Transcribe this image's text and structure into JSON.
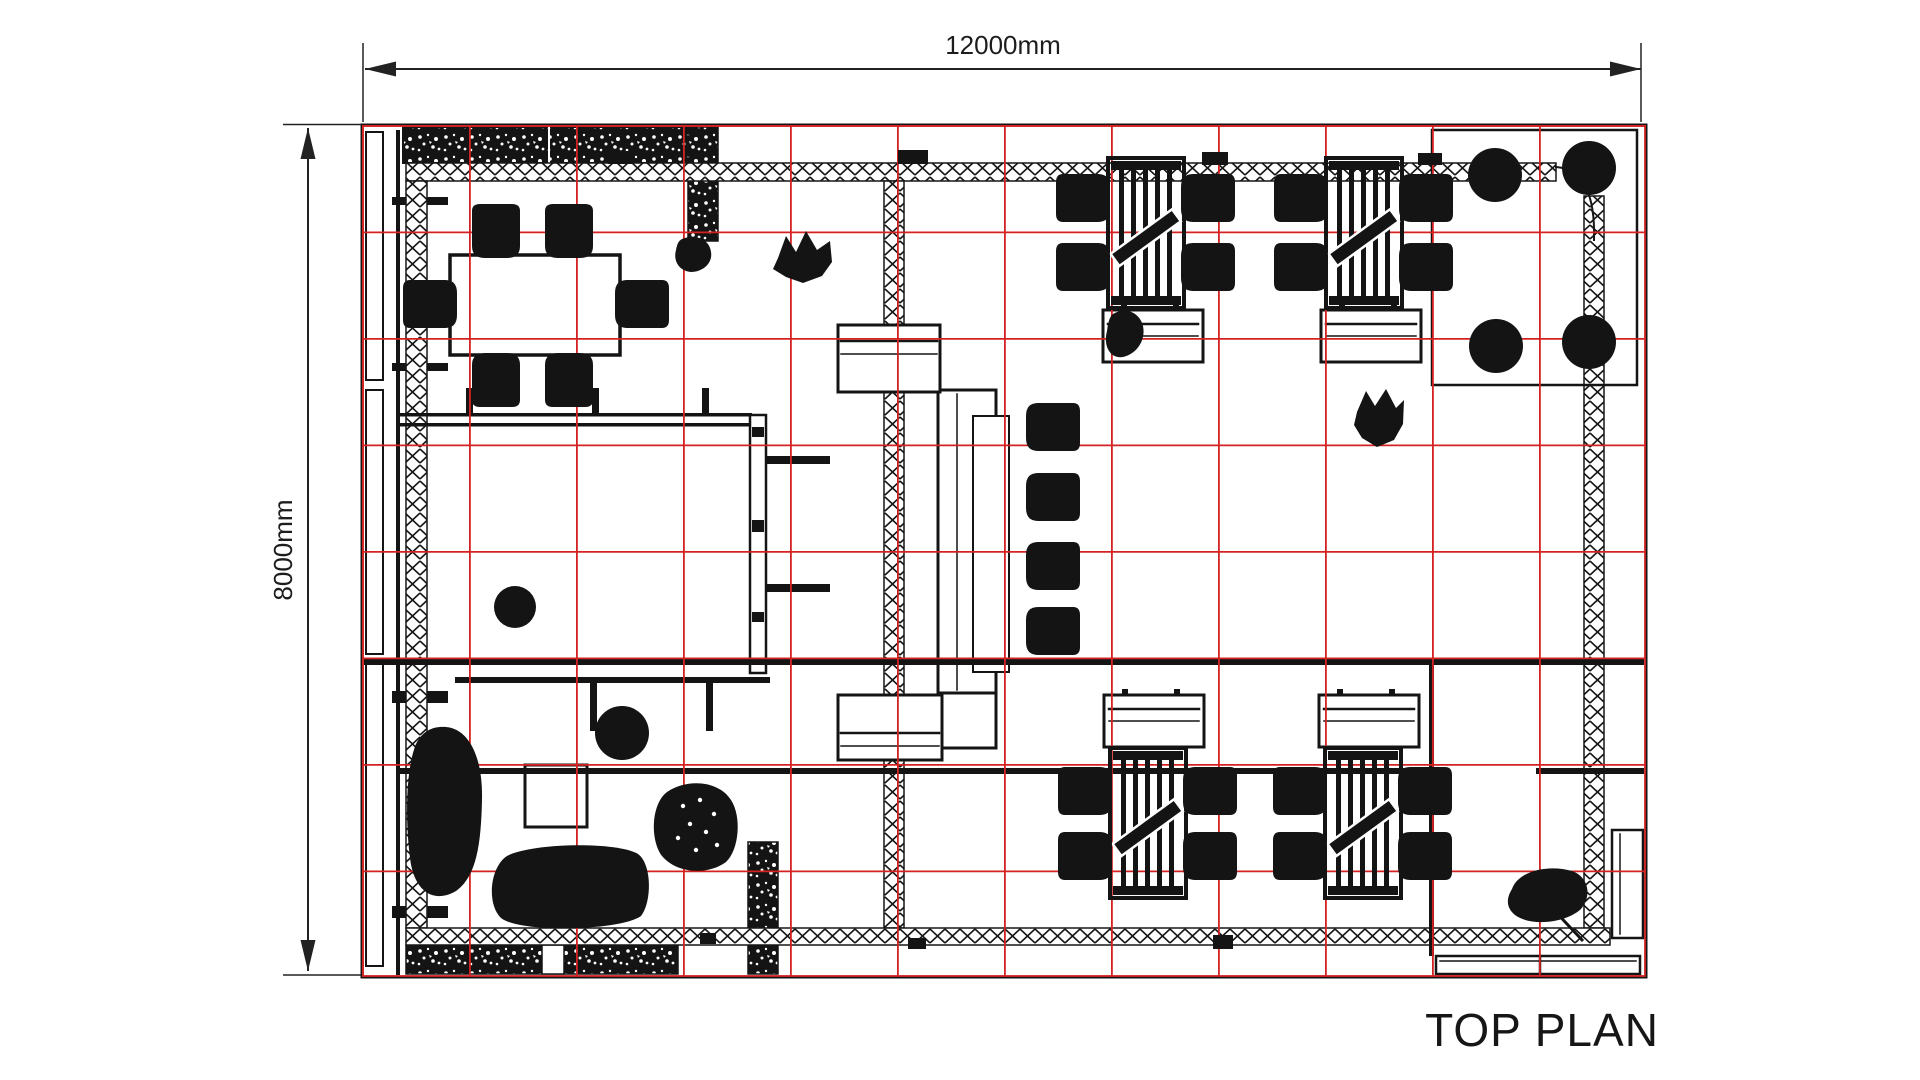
{
  "plan": {
    "title": "TOP PLAN",
    "dimensions": {
      "width": "12000mm",
      "height": "8000mm"
    },
    "grid": {
      "columns": 12,
      "rows": 8,
      "color": "#d42222"
    },
    "ink_color": "#141414",
    "background": "#ffffff"
  }
}
